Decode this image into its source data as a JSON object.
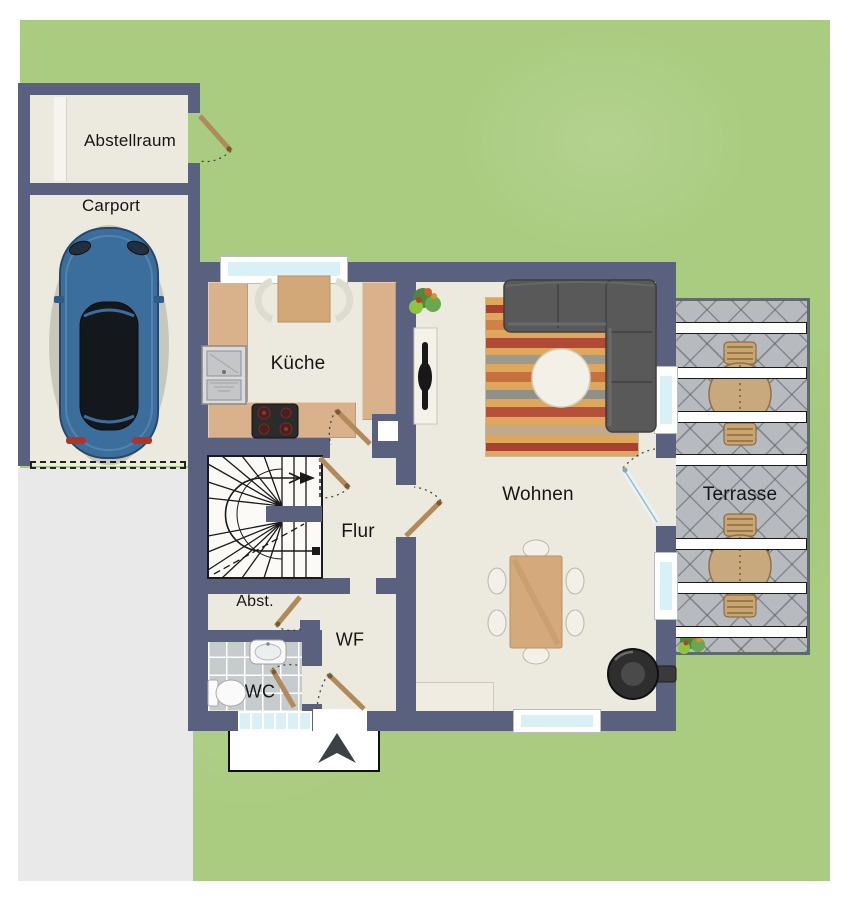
{
  "labels": {
    "abstellraum": "Abstellraum",
    "carport": "Carport",
    "kueche": "Küche",
    "wohnen": "Wohnen",
    "flur": "Flur",
    "abst": "Abst.",
    "wf": "WF",
    "wc": "WC",
    "terrasse": "Terrasse"
  },
  "colors": {
    "wall": "#5a617e",
    "lawn": "#a9cc80",
    "floor": "#eceadf",
    "counter": "#d9b28b",
    "driveway": "#e9e9e9",
    "terrace_tile": "#b7babf",
    "wc_tile": "#c6cbce",
    "window_glass": "#d9f1f6",
    "door_wood": "#b08a5a",
    "sofa": "#595959",
    "rug_base": "#dfa75c",
    "car_body": "#3c6e9d",
    "porch": "#ffffff",
    "label_text": "#151515"
  }
}
